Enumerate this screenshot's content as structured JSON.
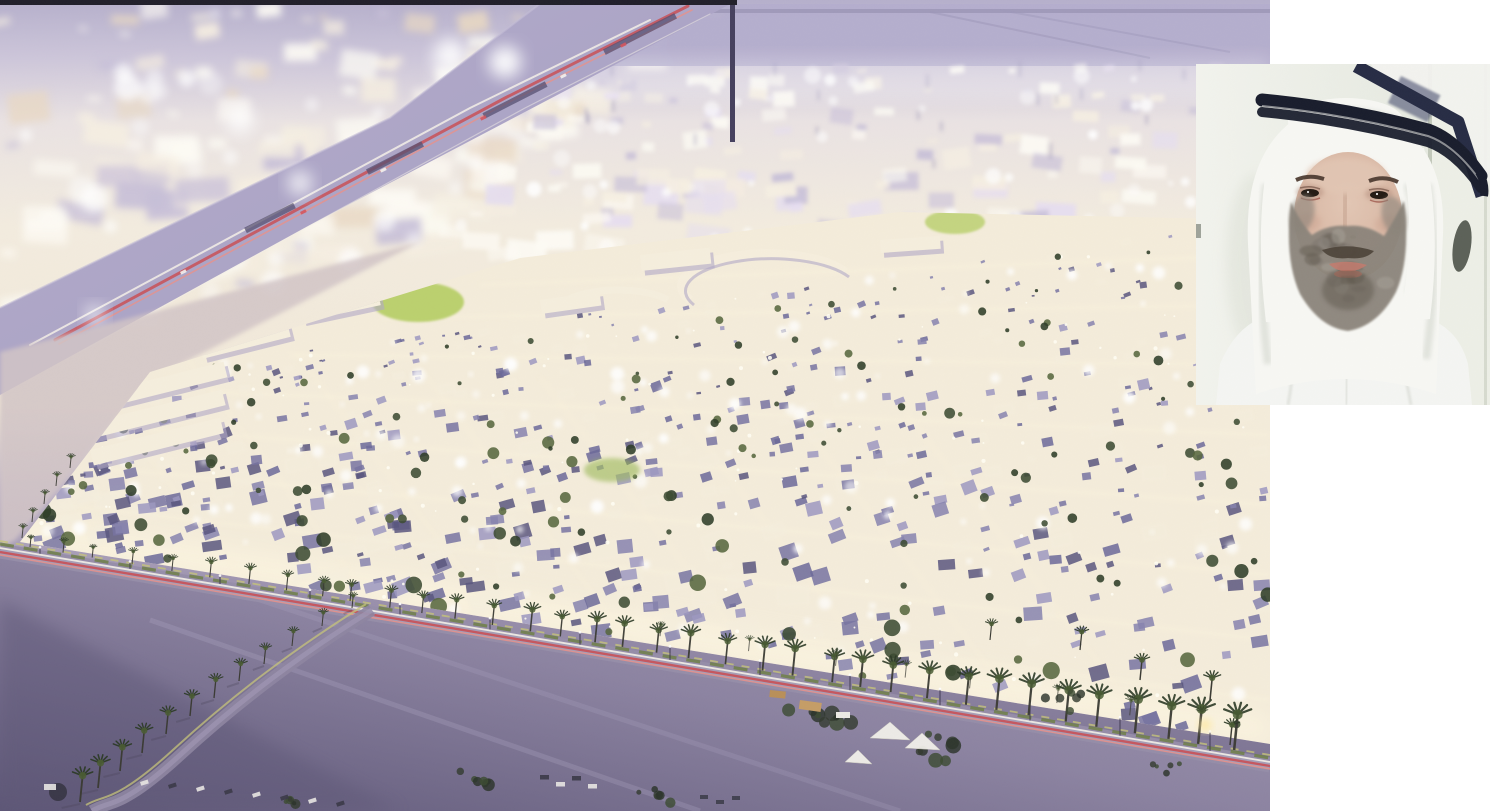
{
  "figures": {
    "aerial": {
      "description": "Dusk aerial rendering of a large illuminated master-planned residential community beside a motorway, surrounded by purple-grey desert with palm-lined boundary roads and red car-light trails"
    },
    "portrait": {
      "description": "Inset portrait photo of a bearded man wearing a white ghutra with a black agal and white thobe"
    }
  },
  "palette": {
    "page_bg": "#ffffff",
    "top_strip": "#211f2a",
    "haze_base": "#ece4e4",
    "haze_cream": "#f6efe2",
    "haze_white": "#fdfbf4",
    "haze_lavender": "#c7bfd8",
    "haze_tan": "#e9d9c4",
    "far_band": "#b4aecd",
    "far_band_line": "#9b95b5",
    "motorway_a": "#b6afcc",
    "motorway_b": "#a29ac0",
    "gantry": "#554f70",
    "pylon": "#46405e",
    "trail_red": "#c94f55",
    "trail_red_light": "#e8918a",
    "trail_white": "#f4f0e7",
    "dev_base": "#f4ecda",
    "dev_glow": "#fff8e2",
    "roof_1": "#8683ae",
    "roof_2": "#6b6899",
    "roof_3": "#9c98c0",
    "roof_4": "#59567e",
    "roof_5": "#7773a1",
    "tree_1": "#3c4b32",
    "tree_2": "#2e3c27",
    "tree_3": "#56673d",
    "lawn": "#b8cf69",
    "cream_block": "#f5eedd",
    "block_shadow": "#b0a8c6",
    "sand_light": "#a89fb6",
    "sand_mid": "#8c83a1",
    "sand_dark": "#5d5676",
    "left_strip": "#d2c5c6",
    "road_bed": "#968da9",
    "road_light": "#b3aabf",
    "verge_green": "#6f7f47",
    "curb_yellow": "#c6c379",
    "palm_trunk": "#3a3a33",
    "palm_head": "#2c3a26",
    "palm_head_light": "#4a5c33",
    "tent_white": "#f2f0ea",
    "truck_tan": "#c59d66",
    "car_dark": "#3a3947",
    "car_white": "#e8e6e2",
    "lamp_glow": "#ffe9a0"
  },
  "portrait_palette": {
    "bg_left": "#f2f3ed",
    "bg_right": "#e3e7dd",
    "wall_line": "#c2c8ba",
    "wall_band": "#edf0e7",
    "frame_dark": "#272c44",
    "frame_matte": "#f2f2ee",
    "frame_inner": "#4a5070",
    "dark_object": "#4b5148",
    "ghutra_white": "#f7f7f3",
    "ghutra_shadow": "#d8dbd3",
    "agal_black": "#191d2c",
    "skin": "#d3af9b",
    "skin_light": "#e2c6b4",
    "skin_shadow": "#b78f7c",
    "brow": "#4e3c31",
    "eye_dark": "#241b14",
    "eye_rim": "#a05a4d",
    "beard_main": "#8b847a",
    "beard_dark": "#5f584e",
    "beard_light": "#aaa59b",
    "mustache": "#4f463b",
    "lip": "#c07b6e",
    "thobe": "#f4f5f2",
    "thobe_shadow": "#dcded8"
  }
}
